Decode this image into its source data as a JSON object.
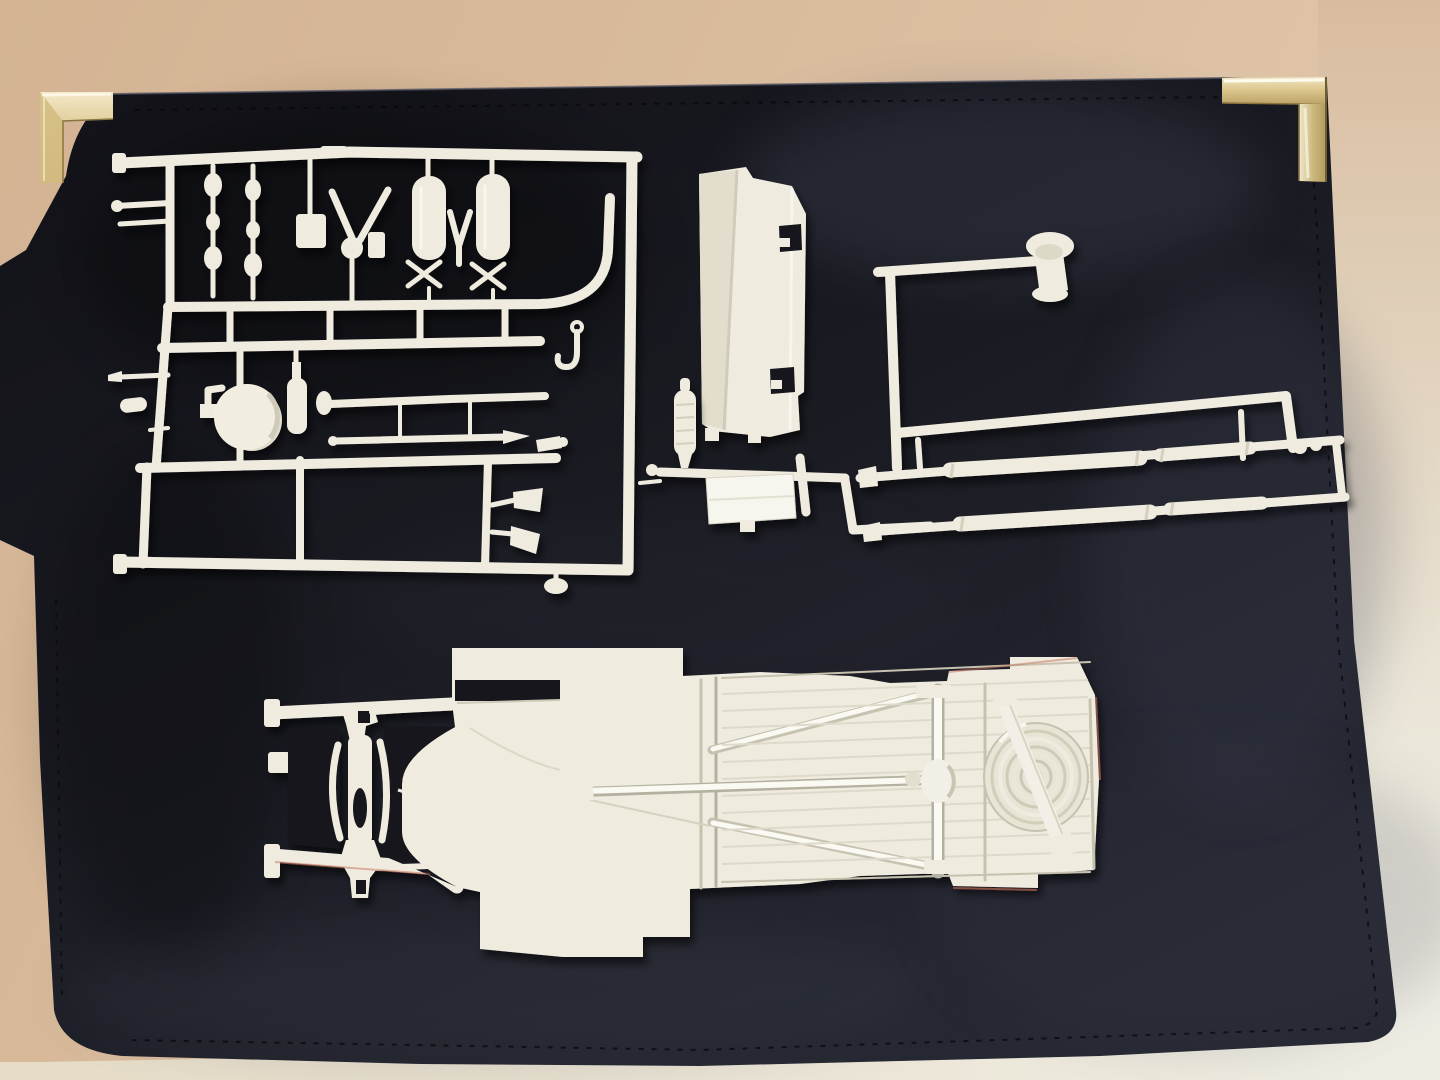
{
  "meta": {
    "type": "photograph",
    "description": "White plastic model kit sprues and a truck chassis frame with spare tire, laid out on a black padfolio case with brass corner protectors, photographed on a beige surface"
  },
  "colors": {
    "wall": "#d9bb9e",
    "wall_light": "#e9e6dc",
    "table": "#e8e0cf",
    "case": "#17171e",
    "case_sheen": "#4a4e61",
    "plastic": "#efecdf",
    "plastic_bright": "#faf9f2",
    "plastic_shadow": "#c3bfac",
    "gold": "#d8c48b",
    "gold_bright": "#f3ebcf",
    "gold_dark": "#a08a52",
    "fringe_red": "#c4705c"
  },
  "objects": {
    "background": {
      "label": "beige tabletop and pale wall behind the case"
    },
    "case": {
      "label": "black padfolio display case with stitched edges"
    },
    "corner_protectors": [
      {
        "label": "brass corner protector, top left"
      },
      {
        "label": "brass corner protector, top right"
      }
    ],
    "parts": [
      {
        "id": "detail_sprue",
        "label": "sprue of small detail parts: air tanks, frame fittings, exhaust pipes, air cleaner drum, horns and tow hook"
      },
      {
        "id": "panel",
        "label": "white cab/bed panel part with two rectangular slots"
      },
      {
        "id": "driveline_sprue",
        "label": "sprue with drive shafts, runners, flanged mount and flat box panel"
      },
      {
        "id": "chassis",
        "label": "truck chassis floor pan with front frame rails, X-bracing, drive shaft, rear axle and spare tire"
      }
    ]
  }
}
